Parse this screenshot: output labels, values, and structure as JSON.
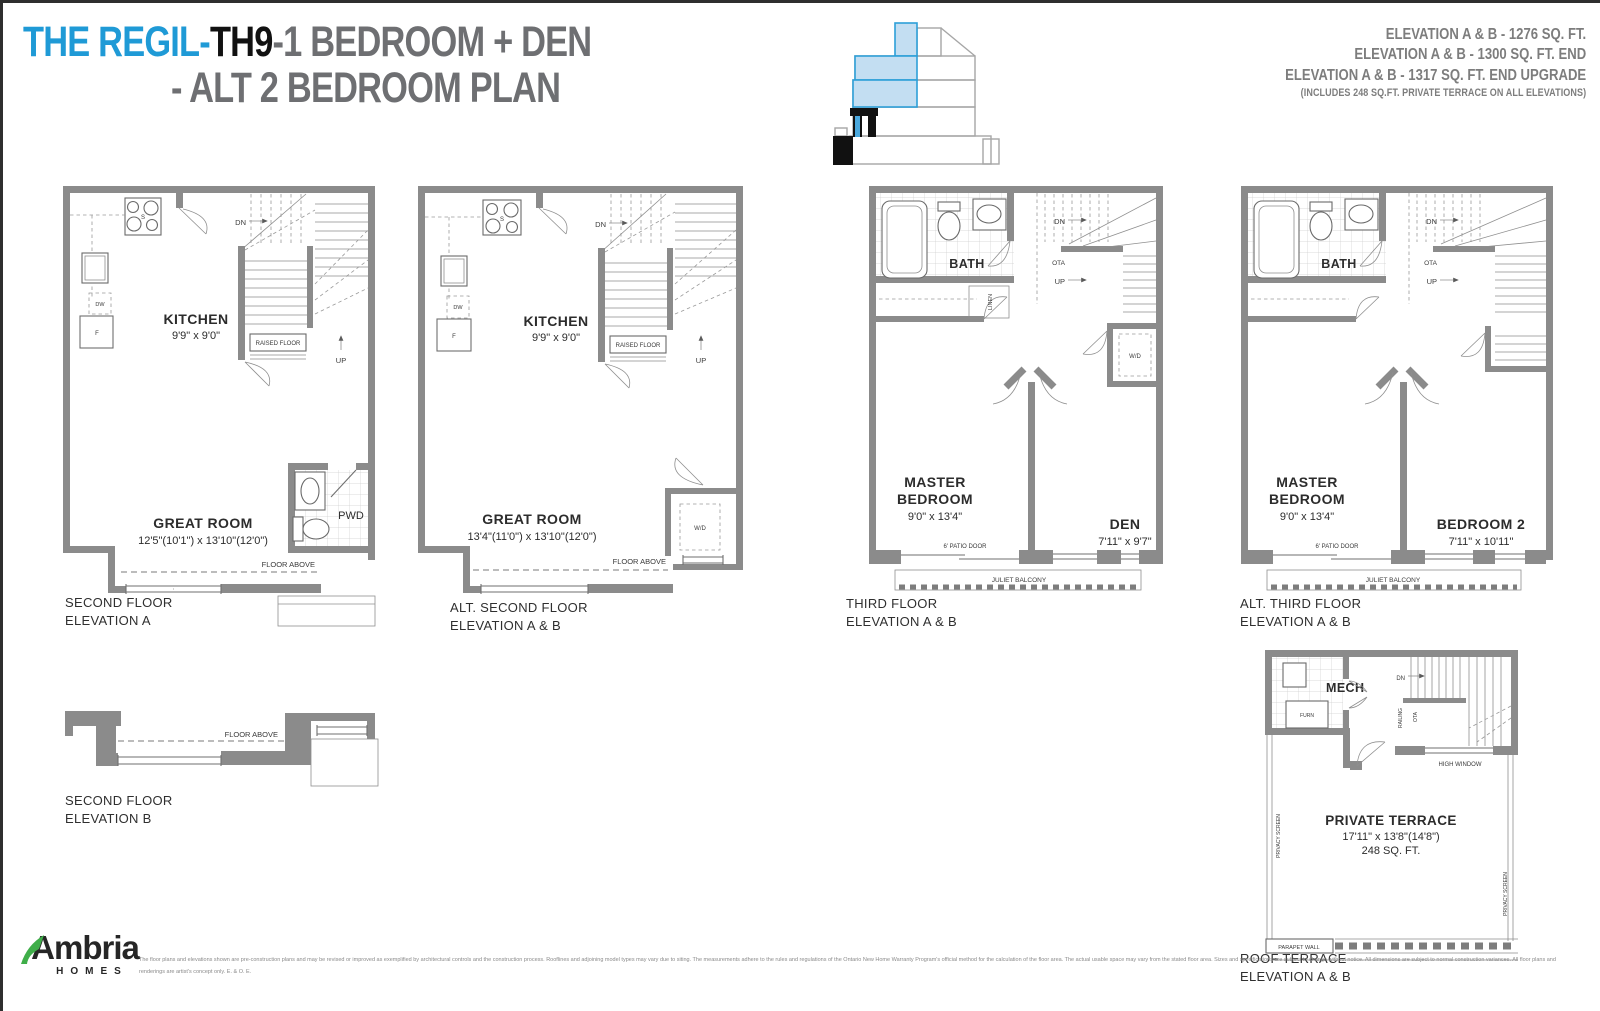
{
  "header": {
    "title_blue": "THE REGIL-",
    "title_model": "TH9",
    "title_rest": "-1 BEDROOM + DEN",
    "title_line2": "- ALT 2 BEDROOM PLAN",
    "elev1": "ELEVATION A & B - 1276  SQ. FT.",
    "elev2": "ELEVATION A & B - 1300 SQ. FT. END",
    "elev3": "ELEVATION A & B - 1317 SQ. FT. END UPGRADE",
    "elev_note": "(INCLUDES 248 SQ.FT. PRIVATE TERRACE ON ALL ELEVATIONS)"
  },
  "plans": {
    "second_a": {
      "cap1": "SECOND FLOOR",
      "cap2": "ELEVATION A",
      "kitchen": "KITCHEN",
      "kitchen_dims": "9'9\" x 9'0\"",
      "great": "GREAT ROOM",
      "great_dims": "12'5\"(10'1\") x 13'10\"(12'0\")",
      "pwd": "PWD",
      "dn": "DN",
      "up": "UP",
      "raised": "RAISED FLOOR",
      "floor_above": "FLOOR ABOVE",
      "dw": "DW",
      "f": "F",
      "s": "S"
    },
    "second_alt": {
      "cap1": "ALT. SECOND FLOOR",
      "cap2": "ELEVATION A & B",
      "kitchen": "KITCHEN",
      "kitchen_dims": "9'9\" x 9'0\"",
      "great": "GREAT ROOM",
      "great_dims": "13'4\"(11'0\") x 13'10\"(12'0\")",
      "wd": "W/D",
      "dn": "DN",
      "up": "UP",
      "raised": "RAISED FLOOR",
      "floor_above": "FLOOR ABOVE",
      "dw": "DW",
      "f": "F",
      "s": "S"
    },
    "third": {
      "cap1": "THIRD FLOOR",
      "cap2": "ELEVATION A & B",
      "bath": "BATH",
      "linen": "LINEN",
      "wd": "W/D",
      "master1": "MASTER",
      "master2": "BEDROOM",
      "master_dims": "9'0\" x 13'4\"",
      "den": "DEN",
      "den_dims": "7'11\" x 9'7\"",
      "patio": "6' PATIO DOOR",
      "juliet": "JULIET BALCONY",
      "dn": "DN",
      "ota": "OTA",
      "up": "UP"
    },
    "third_alt": {
      "cap1": "ALT. THIRD FLOOR",
      "cap2": "ELEVATION A & B",
      "bath": "BATH",
      "master1": "MASTER",
      "master2": "BEDROOM",
      "master_dims": "9'0\" x 13'4\"",
      "bed2": "BEDROOM 2",
      "bed2_dims": "7'11\" x 10'11\"",
      "patio": "6' PATIO DOOR",
      "juliet": "JULIET BALCONY",
      "dn": "DN",
      "ota": "OTA",
      "up": "UP"
    },
    "second_b": {
      "cap1": "SECOND FLOOR",
      "cap2": "ELEVATION B",
      "floor_above": "FLOOR ABOVE"
    },
    "roof": {
      "cap1": "ROOF TERRACE",
      "cap2": "ELEVATION A & B",
      "mech": "MECH",
      "furn": "FURN",
      "dn": "DN",
      "railing": "RAILING",
      "ota": "OTA",
      "high_window": "HIGH WINDOW",
      "terrace": "PRIVATE TERRACE",
      "terrace_dims": "17'11\" x 13'8\"(14'8\")",
      "terrace_area": "248 SQ. FT.",
      "privacy": "PRIVACY SCREEN",
      "parapet": "PARAPET WALL"
    }
  },
  "footer": {
    "brand": "Ambria",
    "brand_sub": "HOMES",
    "disclaimer": "The floor plans and elevations shown are pre-construction plans and may be revised or improved as exemplified by architectural controls and the construction process. Rooflines and adjoining model types may vary due to siting. The measurements adhere to the rules and regulations of the Ontario New Home Warranty Program's official method for the calculation of the floor area. The actual usable space may vary from the stated floor area. Sizes and specifications are subject to change without notice. All dimensions are subject to normal construction variances. All floor plans and renderings are artist's concept only. E. & O. E."
  },
  "colors": {
    "accent_blue": "#1f9ad6",
    "key_fill": "#c3def2",
    "wall_gray": "#8b8b8b",
    "logo_green": "#3fae49"
  }
}
